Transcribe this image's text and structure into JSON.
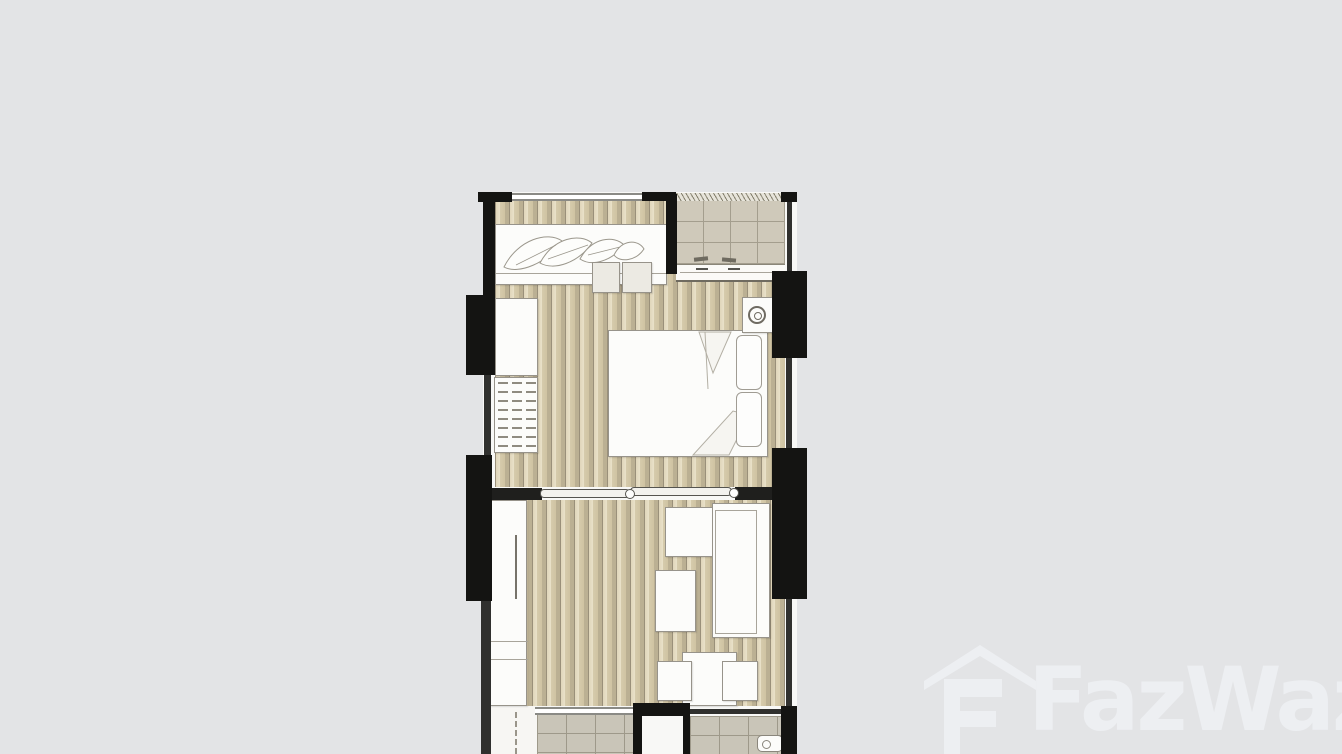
{
  "page": {
    "type": "floor-plan-image",
    "background_color": "#e3e4e6"
  },
  "watermark": {
    "brand": "FazWaz",
    "icon": "fazwaz-house-logo",
    "color": "#edeff2"
  },
  "floor_plan": {
    "wall_color": "#141412",
    "wood_floor_colors": [
      "#e9e1c9",
      "#bbb093"
    ],
    "balcony_tile_color": "#cfc9ba",
    "bathroom_tile_color": "#c9c5b8",
    "furniture_color": "#fcfcfa",
    "elements": [
      "wardrobe-with-clothes",
      "bench-stools",
      "washing-machine",
      "double-bed",
      "pillows",
      "closet-cabinet",
      "shelf-unit",
      "sliding-doors",
      "balcony",
      "kitchen-counter",
      "tv-cabinet",
      "sofa",
      "coffee-table",
      "dining-table",
      "dining-chairs",
      "bathroom-left",
      "bathroom-right",
      "toilet-fixture",
      "entry-door"
    ]
  }
}
